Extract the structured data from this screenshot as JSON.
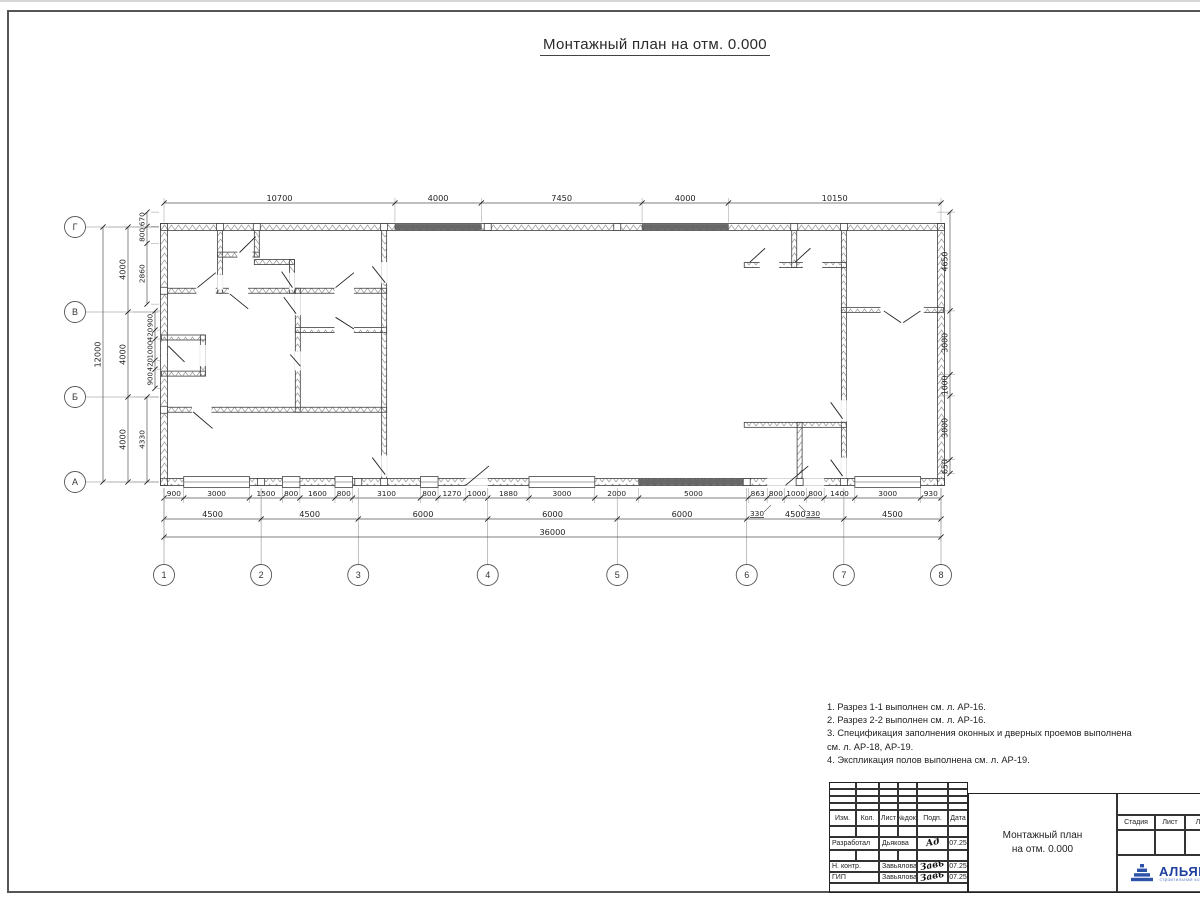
{
  "sheet": {
    "title": "Монтажный план на отм. 0.000"
  },
  "plan": {
    "origin": {
      "x": 164,
      "y": 227
    },
    "scale": {
      "x": 0.021583,
      "y": 0.02125
    },
    "axes": {
      "cols": [
        [
          "1",
          0
        ],
        [
          "2",
          4500
        ],
        [
          "3",
          9000
        ],
        [
          "4",
          15000
        ],
        [
          "5",
          21000
        ],
        [
          "6",
          27000
        ],
        [
          "7",
          31500
        ],
        [
          "8",
          36000
        ]
      ],
      "rows": [
        [
          "Г",
          0
        ],
        [
          "В",
          4000
        ],
        [
          "Б",
          8000
        ],
        [
          "А",
          12000
        ]
      ],
      "col_bubble_y": 575,
      "row_bubble_x": 75
    },
    "walls": [
      [
        0,
        0,
        36000,
        0,
        7
      ],
      [
        0,
        12000,
        36000,
        12000,
        7
      ],
      [
        0,
        0,
        0,
        12000,
        7
      ],
      [
        36000,
        0,
        36000,
        12000,
        7
      ],
      [
        0,
        3000,
        10200,
        3000,
        5
      ],
      [
        2600,
        0,
        2600,
        3000,
        5
      ],
      [
        2600,
        1300,
        4300,
        1300,
        5
      ],
      [
        4300,
        0,
        4300,
        1300,
        5
      ],
      [
        4300,
        1650,
        5930,
        1650,
        5
      ],
      [
        5930,
        1650,
        5930,
        3000,
        5
      ],
      [
        6200,
        3000,
        6200,
        8600,
        5
      ],
      [
        6200,
        4850,
        10200,
        4850,
        5
      ],
      [
        0,
        8600,
        10200,
        8600,
        5
      ],
      [
        0,
        5200,
        1800,
        5200,
        5
      ],
      [
        1800,
        5200,
        1800,
        6900,
        5
      ],
      [
        0,
        6900,
        1800,
        6900,
        5
      ],
      [
        10200,
        0,
        10200,
        12000,
        5
      ],
      [
        31500,
        0,
        31500,
        12000,
        5
      ],
      [
        27000,
        1790,
        31500,
        1790,
        5
      ],
      [
        29200,
        0,
        29200,
        1790,
        5
      ],
      [
        31500,
        3900,
        36000,
        3900,
        5
      ],
      [
        27000,
        9310,
        31500,
        9310,
        5
      ],
      [
        29450,
        9310,
        29450,
        12000,
        5
      ]
    ],
    "gaps": [
      [
        1500,
        2870,
        2400,
        3130
      ],
      [
        3000,
        2870,
        3900,
        3130
      ],
      [
        7900,
        2870,
        8800,
        3130
      ],
      [
        6070,
        3200,
        6330,
        4100
      ],
      [
        6070,
        5900,
        6330,
        6700
      ],
      [
        7900,
        4720,
        8800,
        4980
      ],
      [
        1300,
        8470,
        2200,
        8730
      ],
      [
        10070,
        1700,
        10330,
        2600
      ],
      [
        10070,
        10800,
        10330,
        11700
      ],
      [
        31370,
        8200,
        31630,
        9100
      ],
      [
        31370,
        10900,
        31630,
        11800
      ],
      [
        27600,
        1660,
        28500,
        1920
      ],
      [
        29600,
        1660,
        30500,
        1920
      ],
      [
        33200,
        3770,
        35200,
        4030
      ],
      [
        1670,
        5600,
        1930,
        6500
      ],
      [
        2470,
        2300,
        2730,
        2900
      ],
      [
        5800,
        2200,
        6060,
        2900
      ],
      [
        3400,
        1170,
        4100,
        1430
      ],
      [
        -130,
        5500,
        130,
        6400
      ],
      [
        13986,
        11870,
        15002,
        12130
      ],
      [
        27946,
        11870,
        28758,
        12130
      ],
      [
        28758,
        11870,
        29774,
        12130
      ],
      [
        29774,
        11870,
        30586,
        12130
      ]
    ],
    "windows": [
      [
        914,
        3961
      ],
      [
        5485,
        6297
      ],
      [
        7923,
        8735
      ],
      [
        11884,
        12697
      ],
      [
        16912,
        19959
      ],
      [
        32008,
        35055
      ]
    ],
    "dark_bands": [
      [
        10700,
        14700,
        0
      ],
      [
        22150,
        26150,
        0
      ],
      [
        21990,
        27070,
        12000
      ]
    ],
    "squares": [
      [
        2600,
        0
      ],
      [
        4300,
        0
      ],
      [
        10200,
        0
      ],
      [
        15000,
        0
      ],
      [
        21000,
        0
      ],
      [
        29200,
        0
      ],
      [
        31500,
        0
      ],
      [
        0,
        3000
      ],
      [
        0,
        8600
      ],
      [
        4500,
        12000
      ],
      [
        9000,
        12000
      ],
      [
        10200,
        12000
      ],
      [
        27000,
        12000
      ],
      [
        29450,
        12000
      ],
      [
        31500,
        12000
      ]
    ],
    "swings": [
      [
        1550,
        2850,
        2400,
        2150
      ],
      [
        3050,
        3150,
        3900,
        3850
      ],
      [
        7950,
        2850,
        8800,
        2150
      ],
      [
        3500,
        1200,
        4250,
        450
      ],
      [
        5450,
        2100,
        5950,
        2850
      ],
      [
        5550,
        3300,
        6120,
        4080
      ],
      [
        5850,
        6000,
        6320,
        6550
      ],
      [
        7950,
        4250,
        8800,
        4800
      ],
      [
        1350,
        8700,
        2250,
        9480
      ],
      [
        9650,
        1850,
        10250,
        2620
      ],
      [
        9650,
        10850,
        10250,
        11650
      ],
      [
        13990,
        12150,
        15050,
        11250
      ],
      [
        28800,
        12150,
        29850,
        11250
      ],
      [
        30890,
        8250,
        31440,
        9020
      ],
      [
        30890,
        10950,
        31440,
        11720
      ],
      [
        27150,
        1650,
        27850,
        1000
      ],
      [
        29250,
        1650,
        29950,
        1000
      ],
      [
        33350,
        3950,
        34150,
        4500
      ],
      [
        35050,
        3950,
        34250,
        4500
      ],
      [
        200,
        5600,
        950,
        6350
      ]
    ],
    "dims": {
      "h_chains": [
        {
          "y": 203,
          "ext": [
            198,
            222
          ],
          "fs": 8.2,
          "ticks": [
            0,
            10700,
            14700,
            22150,
            26150,
            36000
          ],
          "labels": [
            "10700",
            "4000",
            "7450",
            "4000",
            "10150"
          ]
        },
        {
          "y": 498,
          "ext": [
            488,
            503
          ],
          "fs": 7.4,
          "ticks": [
            0,
            914,
            3961,
            5485,
            6297,
            7923,
            8735,
            11884,
            12697,
            13986,
            15002,
            16912,
            19959,
            21990,
            27070,
            27946,
            28758,
            29774,
            30586,
            32008,
            35055,
            36000
          ],
          "labels": [
            "900",
            "3000",
            "1500",
            "800",
            "1600",
            "800",
            "3100",
            "800",
            "1270",
            "1000",
            "1880",
            "3000",
            "2000",
            "5000",
            "863",
            "800",
            "1000",
            "800",
            "1400",
            "3000",
            "930"
          ]
        },
        {
          "y": 519,
          "ext": [
            488,
            524
          ],
          "fs": 8.2,
          "ticks": [
            0,
            4500,
            9000,
            15000,
            21000,
            27000,
            31500,
            36000
          ],
          "labels": [
            "4500",
            "4500",
            "6000",
            "6000",
            "6000",
            "4500",
            "4500"
          ]
        },
        {
          "y": 537,
          "ext": [
            488,
            542
          ],
          "fs": 8.2,
          "ticks": [
            0,
            36000
          ],
          "labels": [
            "36000"
          ]
        }
      ],
      "v_chains": [
        {
          "x": 103,
          "ext": [
            108,
            159
          ],
          "fs": 8.2,
          "ticks": [
            0,
            12000
          ],
          "labels": [
            "12000"
          ]
        },
        {
          "x": 128,
          "ext": [
            133,
            159
          ],
          "fs": 8.2,
          "ticks": [
            0,
            4000,
            8000,
            12000
          ],
          "labels": [
            "4000",
            "4000",
            "4000"
          ]
        },
        {
          "x": 147,
          "ext": [
            151,
            159
          ],
          "fs": 7.4,
          "ticks": [
            -700,
            -30,
            770,
            3630
          ],
          "labels": [
            "670",
            "800",
            "2860"
          ]
        },
        {
          "x": 147,
          "ext": [
            151,
            159
          ],
          "fs": 7.4,
          "ticks": [
            8000,
            12000
          ],
          "labels": [
            "4330"
          ]
        },
        {
          "x": 155,
          "ext": [
            157,
            160
          ],
          "fs": 7.0,
          "ticks": [
            3950,
            4850,
            5270,
            6270,
            6690,
            7590
          ],
          "labels": [
            "900",
            "420",
            "1000",
            "420",
            "900"
          ]
        },
        {
          "x": 950,
          "ext": [
            937,
            955
          ],
          "fs": 7.8,
          "ticks": [
            -700,
            3950,
            6950,
            7950,
            10950,
            11600
          ],
          "labels": [
            "4650",
            "3000",
            "1000",
            "3000",
            "650"
          ]
        }
      ],
      "callouts": [
        {
          "t": "330",
          "x": 757,
          "y": 516,
          "l": [
            764,
            512,
            771,
            505
          ]
        },
        {
          "t": "330",
          "x": 813,
          "y": 516,
          "l": [
            806,
            512,
            799,
            505
          ]
        }
      ]
    }
  },
  "notes": {
    "lines": [
      "1. Разрез 1-1 выполнен см. л. АР-16.",
      "2. Разрез 2-2 выполнен см. л. АР-16.",
      "3. Спецификация заполнения оконных и дверных проемов выполнена",
      "см. л. АР-18, АР-19.",
      "4. Экспликация полов выполнена см. л. АР-19."
    ]
  },
  "titleblock": {
    "rev_header": [
      "Изм.",
      "Кол.",
      "Лист",
      "№док.",
      "Подп.",
      "Дата"
    ],
    "rows": [
      {
        "role": "Разработал",
        "name": "Дьякова",
        "sig": "Ад",
        "date": "07.25"
      },
      {
        "role": "Н. контр.",
        "name": "Завьялова",
        "sig": "Завь",
        "date": "07.25"
      },
      {
        "role": "ГИП",
        "name": "Завьялова",
        "sig": "Завь",
        "date": "07.25"
      }
    ],
    "doc_title_line1": "Монтажный план",
    "doc_title_line2": "на отм. 0.000",
    "stage_header": [
      "Стадия",
      "Лист",
      "Листов"
    ],
    "logo_text": "АЛЬЯНС",
    "logo_subtext": "строительная компания"
  }
}
